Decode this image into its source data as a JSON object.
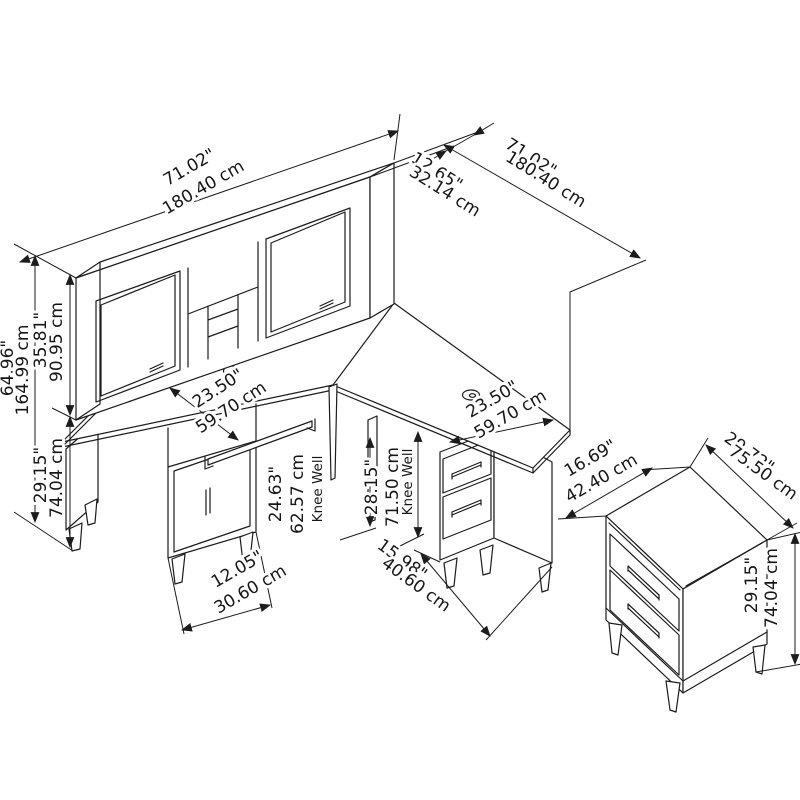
{
  "page": {
    "background": "#ffffff",
    "line_color": "#1c1c1c"
  },
  "diagram": {
    "kind": "furniture-dimension-drawing",
    "pieces": [
      "l-shaped-desk-with-hutch",
      "lateral-file-cabinet"
    ],
    "dims": {
      "hutch_width": {
        "in": "71.02\"",
        "cm": "180.40 cm"
      },
      "hutch_depth": {
        "in": "12.65\"",
        "cm": "32.14 cm"
      },
      "return_length": {
        "in": "71.02\"",
        "cm": "180.40 cm"
      },
      "overall_height": {
        "in": "64.96\"",
        "cm": "164.99 cm"
      },
      "hutch_height": {
        "in": "35.81\"",
        "cm": "90.95 cm"
      },
      "desk_height": {
        "in": "29.15\"",
        "cm": "74.04 cm"
      },
      "left_desk_depth": {
        "in": "23.50\"",
        "cm": "59.70 cm"
      },
      "right_desk_depth": {
        "in": "23.50\"",
        "cm": "59.70 cm"
      },
      "left_knee_well": {
        "in": "24.63\"",
        "cm": "62.57 cm",
        "note": "Knee Well"
      },
      "left_pedestal_width": {
        "in": "12.05\"",
        "cm": "30.60 cm"
      },
      "right_knee_well": {
        "in": "28.15\"",
        "cm": "71.50 cm",
        "note": "Knee Well"
      },
      "right_pedestal_width": {
        "in": "15.98\"",
        "cm": "40.60 cm"
      },
      "cabinet_depth": {
        "in": "16.69\"",
        "cm": "42.40 cm"
      },
      "cabinet_width": {
        "in": "29.72\"",
        "cm": "75.50 cm"
      },
      "cabinet_height": {
        "in": "29.15\"",
        "cm": "74.04 cm"
      }
    }
  }
}
